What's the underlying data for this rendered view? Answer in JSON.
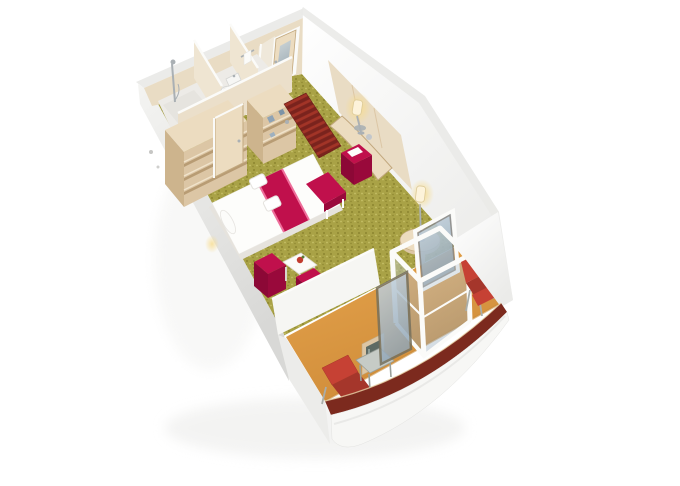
{
  "page": {
    "background": "#ffffff",
    "description": "3D isometric cutaway rendering of a cruise ship balcony cabin floor plan"
  },
  "colors": {
    "carpet_base": "#a9a246",
    "carpet_dark": "#8c852f",
    "carpet_light": "#c6bf66",
    "wood_light": "#ecdcc0",
    "wood_mid": "#dcc6a5",
    "wood_dark": "#c2a87e",
    "wood_pale": "#e9dcc4",
    "wood_side": "#cdb48d",
    "shelf_shadow": "#b89c74",
    "wall_white": "#f7f7f5",
    "wall_top": "#eaeae8",
    "tile": "#edebe7",
    "crimson": "#c0104c",
    "crimson_dark": "#99093b",
    "crimson_deep": "#8c0836",
    "pink_trim": "#ee6f9b",
    "red_chair": "#c64134",
    "red_chair_dark": "#a5362b",
    "balcony_floor": "#e6a44d",
    "balcony_floor_dark": "#cf8c39",
    "hull_stripe": "#7c2a1e",
    "mat_dark": "#7a231d",
    "mat_light": "#a23427",
    "glass_light": "#c8d6e0",
    "glass_dark": "#90a5b6",
    "chrome": "#aab0b4",
    "glow": "#f7dc8e",
    "mirror": "#5d6a64",
    "blue_item": "#8fa3b5",
    "white": "#fdfdfb"
  },
  "scene": {
    "view": "isometric cutaway from above",
    "rooms": [
      {
        "name": "shower-room",
        "features": [
          "shower-column",
          "shower-tray"
        ]
      },
      {
        "name": "toilet-room",
        "features": [
          "toilet",
          "washbasin",
          "mirror"
        ]
      },
      {
        "name": "second-shower-room",
        "features": [
          "towel-rail",
          "towel"
        ]
      },
      {
        "name": "wardrobe-area",
        "features": [
          "open-shelf-unit",
          "closet-door",
          "shelf-unit-with-items"
        ]
      },
      {
        "name": "entrance",
        "features": [
          "cabin-door",
          "striped-mat"
        ]
      },
      {
        "name": "bedroom-lounge",
        "features": [
          "double-bed",
          "bed-runner",
          "folded-towels",
          "bolster-pillow",
          "bench",
          "two-cube-armchairs",
          "coffee-table",
          "desk",
          "desk-lamp",
          "desk-stool",
          "pedestal-side-table",
          "table-lamp"
        ]
      },
      {
        "name": "balcony",
        "features": [
          "glass-door-assembly",
          "open-glass-door",
          "lounger",
          "side-table",
          "deck-chair",
          "wood-panel-mirror"
        ]
      },
      {
        "name": "ship-hull",
        "features": [
          "red-accent-stripe",
          "white-hull-band"
        ]
      }
    ]
  }
}
